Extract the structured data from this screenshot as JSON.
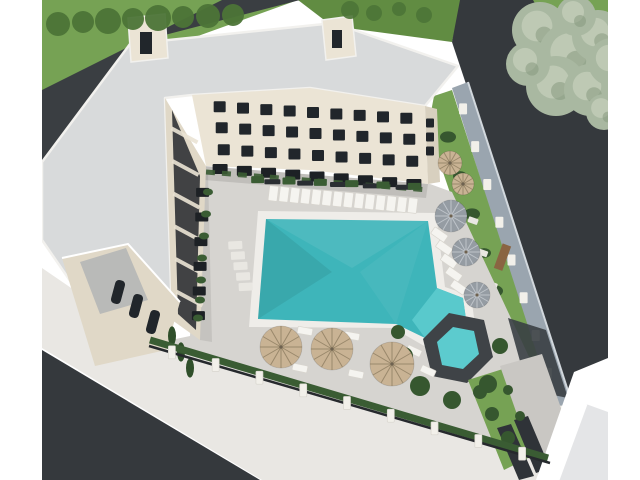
{
  "image": {
    "kind": "3d-architectural-aerial-rendering",
    "subject": "U-shaped cream apartment building around a courtyard with a large turquoise swimming pool, spa, sun deck with loungers and umbrellas, perimeter stone wall, surrounding asphalt roads and lawns",
    "width": 640,
    "height": 480
  },
  "palette": {
    "white": "#ffffff",
    "grass": "#76a254",
    "grassDark": "#618c42",
    "treeDark": "#4c7437",
    "sage": "#a9b8a1",
    "sageLight": "#c9d2bf",
    "sageDark": "#86997f",
    "road": "#35393d",
    "roadNW": "#3a3e42",
    "roof": "#d8dadb",
    "roofEdge": "#f2f1ee",
    "cream": "#ebe4d5",
    "creamShade": "#e0d8c7",
    "gable": "#d8d0bf",
    "windowDark": "#21262b",
    "balconyDark": "#24282d",
    "patioDark": "#1d2125",
    "deck": "#d6d4d0",
    "deckPad": "#e9e7e2",
    "sidewalk": "#e9e7e3",
    "coping": "#efede9",
    "poolTeal": "#3eb5ba",
    "poolShallow": "#5ccbce",
    "wallStone": "#9aa5af",
    "wallCap": "#d2d8dd",
    "postWhite": "#f2f0ea",
    "hedge": "#3a5c33",
    "bush": "#36572f",
    "cypress": "#2f4f2a",
    "umbrellaBeige": "#c9b394",
    "umbrellaBeigeSpoke": "#8a7a5e",
    "umbrellaGray": "#959ca3",
    "umbrellaGraySpoke": "#cdd2d7",
    "lounger": "#f5f4f0",
    "loungerEdge": "#d8d5ce",
    "spaStone": "#3f4347",
    "paving": "#c9c7c3",
    "ramp": "#3a3f44",
    "stairDark": "#2f3338",
    "benchDark": "#2a2e32",
    "woodBench": "#8a6442",
    "clubRoof": "#e4e5e7",
    "fenceDark": "#26292d",
    "grayWall": "#b9bab8"
  },
  "objects": {
    "rows": [
      {
        "g": "sunbed",
        "name": "sunbed",
        "from": [
          268,
          193
        ],
        "to": [
          418,
          206
        ],
        "n": 14,
        "w": 9,
        "h": 15,
        "rot": 7,
        "fill": "lounger",
        "stroke": "loungerEdge"
      },
      {
        "g": "deck-pad-left",
        "name": "paving-pad",
        "from": [
          234,
          240
        ],
        "to": [
          247,
          292
        ],
        "n": 5,
        "w": 14,
        "h": 8,
        "rot": -3,
        "fill": "deckPad"
      },
      {
        "g": "deck-pad-wall",
        "name": "stepping-stone",
        "from": [
          449,
          140
        ],
        "to": [
          526,
          398
        ],
        "n": 8,
        "w": 10,
        "h": 6,
        "rot": 20,
        "fill": "deckPad"
      },
      {
        "g": "bench",
        "name": "bench",
        "from": [
          256,
          181
        ],
        "to": [
          420,
          188
        ],
        "n": 5,
        "w": 16,
        "h": 5,
        "fill": "benchDark"
      },
      {
        "g": "hedge-box",
        "name": "hedge-planter",
        "from": [
          242,
          179
        ],
        "to": [
          430,
          187
        ],
        "n": 6,
        "w": 13,
        "h": 7,
        "fill": "hedge"
      },
      {
        "g": "fence-post",
        "name": "fence-post",
        "from": [
          150,
          346
        ],
        "to": [
          544,
          460
        ],
        "n": 9,
        "w": 7,
        "h": 13,
        "fill": "postWhite",
        "stroke": "loungerEdge"
      },
      {
        "g": "wall-post",
        "name": "wall-post",
        "from": [
          457,
          90
        ],
        "to": [
          566,
          430
        ],
        "n": 9,
        "w": 8,
        "h": 11,
        "fill": "postWhite"
      },
      {
        "g": "window-row-1",
        "name": "window",
        "from": [
          208,
          106
        ],
        "to": [
          418,
          119
        ],
        "n": 9,
        "w": 12,
        "h": 11,
        "fill": "windowDark"
      },
      {
        "g": "window-row-2",
        "name": "window",
        "from": [
          210,
          127
        ],
        "to": [
          421,
          140
        ],
        "n": 9,
        "w": 12,
        "h": 11,
        "fill": "windowDark"
      },
      {
        "g": "window-row-3",
        "name": "window",
        "from": [
          212,
          149
        ],
        "to": [
          424,
          162
        ],
        "n": 9,
        "w": 12,
        "h": 11,
        "fill": "windowDark"
      },
      {
        "g": "patio-north",
        "name": "ground-patio",
        "from": [
          208,
          168
        ],
        "to": [
          426,
          185
        ],
        "n": 9,
        "w": 15,
        "h": 10,
        "fill": "patioDark"
      },
      {
        "g": "patio-west",
        "name": "ground-patio",
        "from": [
          203,
          180
        ],
        "to": [
          198,
          328
        ],
        "n": 6,
        "w": 13,
        "h": 9,
        "fill": "patioDark"
      },
      {
        "g": "window-gable",
        "name": "window",
        "from": [
          430,
          116
        ],
        "to": [
          430,
          158
        ],
        "n": 3,
        "w": 8,
        "h": 9,
        "fill": "windowDark"
      },
      {
        "g": "lounger-right",
        "name": "lounger",
        "from": [
          437,
          228
        ],
        "to": [
          461,
          294
        ],
        "n": 5,
        "w": 16,
        "h": 8,
        "rot": 35,
        "fill": "lounger",
        "stroke": "loungerEdge"
      }
    ],
    "circles": [
      {
        "g": "trees-row",
        "name": "tree",
        "fill": "treeDark",
        "op": 0.95,
        "items": [
          [
            58,
            24,
            12
          ],
          [
            83,
            22,
            11
          ],
          [
            108,
            21,
            13
          ],
          [
            133,
            19,
            11
          ],
          [
            158,
            18,
            13
          ],
          [
            183,
            17,
            11
          ],
          [
            208,
            16,
            12
          ],
          [
            233,
            15,
            11
          ]
        ]
      },
      {
        "g": "trees-strip",
        "name": "tree",
        "fill": "treeDark",
        "op": 0.9,
        "items": [
          [
            350,
            10,
            9
          ],
          [
            374,
            13,
            8
          ],
          [
            399,
            9,
            7
          ],
          [
            424,
            15,
            8
          ]
        ]
      },
      {
        "g": "tree-big",
        "name": "large-tree",
        "fill": "sage",
        "op": 1,
        "fluffy": true,
        "items": [
          [
            540,
            30,
            28
          ],
          [
            572,
            56,
            34
          ],
          [
            598,
            36,
            26
          ],
          [
            556,
            86,
            30
          ],
          [
            590,
            90,
            26
          ],
          [
            612,
            62,
            24
          ],
          [
            528,
            64,
            22
          ],
          [
            576,
            16,
            20
          ],
          [
            604,
            112,
            18
          ]
        ]
      },
      {
        "g": "bushes-wall",
        "name": "shrub",
        "fill": "bush",
        "op": 1,
        "ry": 0.7,
        "items": [
          [
            448,
            137,
            8
          ],
          [
            460,
            176,
            7
          ],
          [
            472,
            214,
            8
          ],
          [
            484,
            253,
            7
          ],
          [
            495,
            291,
            8
          ],
          [
            507,
            330,
            7
          ],
          [
            519,
            368,
            8
          ],
          [
            531,
            407,
            7
          ]
        ]
      },
      {
        "g": "bushes-spa",
        "name": "shrub",
        "fill": "bush",
        "op": 1,
        "items": [
          [
            404,
            356,
            9
          ],
          [
            420,
            386,
            10
          ],
          [
            452,
            400,
            9
          ],
          [
            488,
            384,
            9
          ],
          [
            500,
            346,
            8
          ],
          [
            398,
            332,
            7
          ]
        ]
      },
      {
        "g": "bushes-br",
        "name": "shrub",
        "fill": "bush",
        "op": 1,
        "items": [
          [
            480,
            392,
            7
          ],
          [
            492,
            414,
            7
          ],
          [
            508,
            438,
            7
          ]
        ]
      },
      {
        "g": "bushes-west",
        "name": "hedge-shrub",
        "fill": "hedge",
        "op": 1,
        "ry": 0.7,
        "items": [
          [
            208,
            192,
            5
          ],
          [
            206,
            214,
            5
          ],
          [
            204,
            236,
            5
          ],
          [
            202,
            258,
            5
          ],
          [
            201,
            280,
            5
          ],
          [
            200,
            300,
            5
          ],
          [
            198,
            318,
            5
          ]
        ]
      },
      {
        "g": "cypresses",
        "name": "cypress-tree",
        "fill": "cypress",
        "op": 1,
        "ry": 2.4,
        "items": [
          [
            172,
            336,
            4
          ],
          [
            181,
            352,
            4
          ],
          [
            190,
            368,
            4
          ]
        ]
      },
      {
        "g": "pot-plants",
        "name": "potted-plant",
        "fill": "bush",
        "op": 1,
        "items": [
          [
            508,
            390,
            5
          ],
          [
            520,
            416,
            5
          ]
        ]
      }
    ],
    "pillars_west": {
      "from": [
        171,
        112
      ],
      "to": [
        177,
        308
      ],
      "n": 6,
      "dx": 26,
      "dy": 14,
      "w": 4,
      "stroke": "cream"
    },
    "umbrellas": [
      {
        "x": 450,
        "y": 163,
        "r": 12,
        "k": "beige"
      },
      {
        "x": 463,
        "y": 184,
        "r": 11,
        "k": "beige"
      },
      {
        "x": 451,
        "y": 216,
        "r": 16,
        "k": "gray"
      },
      {
        "x": 466,
        "y": 252,
        "r": 14,
        "k": "gray"
      },
      {
        "x": 477,
        "y": 295,
        "r": 13,
        "k": "gray"
      },
      {
        "x": 281,
        "y": 347,
        "r": 21,
        "k": "beige"
      },
      {
        "x": 332,
        "y": 349,
        "r": 21,
        "k": "beige"
      },
      {
        "x": 392,
        "y": 364,
        "r": 22,
        "k": "beige"
      }
    ],
    "loungers_free": [
      [
        305,
        331,
        10
      ],
      [
        352,
        336,
        10
      ],
      [
        300,
        368,
        12
      ],
      [
        356,
        374,
        12
      ],
      [
        414,
        351,
        25
      ],
      [
        428,
        371,
        25
      ]
    ]
  }
}
